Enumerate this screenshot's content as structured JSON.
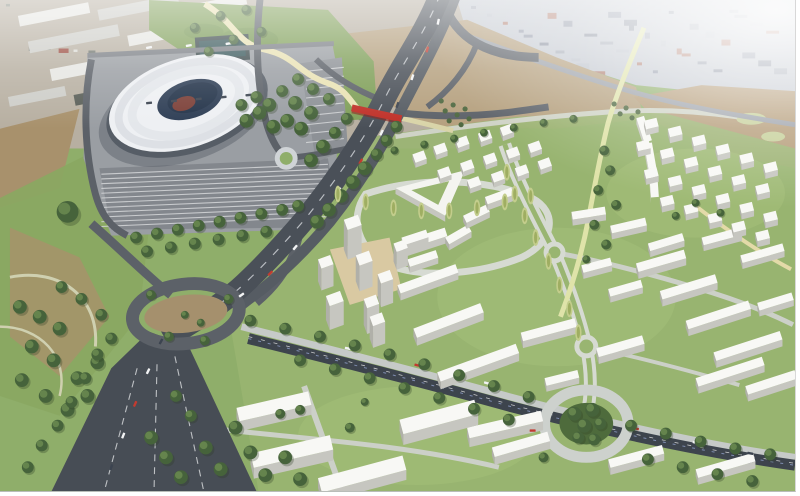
{
  "palette": {
    "grassBase": "#8fae6a",
    "devGrass": "#99b571",
    "grassLight": "#a6c17c",
    "hillGreen": "#7f9f58",
    "parkGreen": "#8aa862",
    "earth": "#b5a07e",
    "earthDark": "#a8916c",
    "fieldBrown": "#b49b77",
    "industrial": "#b7afa1",
    "cityBase": "#c3c8d0",
    "apron": "#9a9ea3",
    "parkingLot": "#83878d",
    "motorway": "#4a5058",
    "motorwayWide": "#474d55",
    "roadMid": "#5c6168",
    "roadLight": "#ccd1cc",
    "railDark": "#3d444d",
    "pathCream": "#e9e2b4",
    "pathOlive": "#dfe3a9",
    "bridgeRed": "#c03028",
    "roofWhite": "#f8f8f5",
    "sideGray": "#c6c6c0",
    "endGray": "#b0b0a9",
    "stadiumRoof": "#eef0f3",
    "stadiumBowl": "#2e3e55",
    "stadiumPlinth": "#565d66",
    "pitchRed": "#7c4038",
    "tree": "#46633b",
    "treeLight": "#6d8c52",
    "poplar": "#c3cd8c",
    "olive": "#4e6840",
    "sand": "#d9c9a2",
    "haze": "#ffffff"
  },
  "buildings": {
    "slabs": [
      [
        398,
        246,
        52,
        -18,
        9,
        7
      ],
      [
        400,
        288,
        62,
        -20,
        9,
        7
      ],
      [
        416,
        332,
        72,
        -21,
        10,
        8
      ],
      [
        440,
        376,
        84,
        -20,
        10,
        8
      ],
      [
        470,
        432,
        76,
        -13,
        11,
        9
      ],
      [
        495,
        452,
        58,
        -16,
        10,
        8
      ],
      [
        448,
        240,
        26,
        -30,
        8,
        6
      ],
      [
        466,
        218,
        26,
        -26,
        8,
        6
      ],
      [
        488,
        199,
        28,
        -20,
        8,
        6
      ],
      [
        575,
        214,
        34,
        -9,
        8,
        6
      ],
      [
        614,
        228,
        36,
        -13,
        8,
        6
      ],
      [
        652,
        246,
        36,
        -17,
        8,
        6
      ],
      [
        585,
        268,
        30,
        -15,
        8,
        6
      ],
      [
        612,
        292,
        34,
        -16,
        8,
        6
      ],
      [
        640,
        266,
        50,
        -16,
        9,
        7
      ],
      [
        664,
        294,
        58,
        -17,
        9,
        7
      ],
      [
        690,
        324,
        66,
        -18,
        9,
        7
      ],
      [
        718,
        356,
        70,
        -18,
        9,
        7
      ],
      [
        750,
        390,
        52,
        -18,
        9,
        7
      ],
      [
        706,
        240,
        40,
        -15,
        8,
        6
      ],
      [
        745,
        258,
        44,
        -16,
        8,
        6
      ],
      [
        762,
        306,
        36,
        -17,
        8,
        6
      ],
      [
        524,
        336,
        56,
        -15,
        9,
        7
      ],
      [
        600,
        352,
        48,
        -16,
        9,
        7
      ],
      [
        700,
        382,
        70,
        -18,
        9,
        7
      ],
      [
        548,
        382,
        34,
        -14,
        8,
        6
      ],
      [
        612,
        464,
        56,
        -15,
        9,
        7
      ],
      [
        700,
        474,
        60,
        -16,
        9,
        7
      ],
      [
        238,
        412,
        74,
        -13,
        14,
        10
      ],
      [
        252,
        458,
        82,
        -13,
        15,
        11
      ],
      [
        402,
        424,
        78,
        -15,
        15,
        11
      ],
      [
        320,
        483,
        88,
        -15,
        15,
        10
      ],
      [
        404,
        240,
        26,
        -18,
        8,
        6
      ],
      [
        410,
        262,
        30,
        -18,
        8,
        6
      ],
      [
        648,
        117,
        26,
        72,
        8,
        6
      ],
      [
        656,
        144,
        26,
        80,
        8,
        6
      ],
      [
        661,
        171,
        28,
        86,
        8,
        6
      ]
    ],
    "towers": [
      [
        346,
        222,
        15,
        -20,
        11,
        30
      ],
      [
        320,
        262,
        13,
        -20,
        10,
        22
      ],
      [
        358,
        258,
        14,
        -20,
        11,
        26
      ],
      [
        380,
        277,
        13,
        -20,
        10,
        24
      ],
      [
        328,
        299,
        15,
        -20,
        11,
        24
      ],
      [
        366,
        302,
        13,
        -20,
        10,
        26
      ],
      [
        396,
        246,
        12,
        -20,
        9,
        18
      ],
      [
        372,
        320,
        13,
        -20,
        10,
        22
      ]
    ],
    "cubes_a": {
      "len": 12,
      "ang": -20,
      "dep": 9,
      "h": 5,
      "points": [
        [
          415,
          156
        ],
        [
          436,
          148
        ],
        [
          458,
          141
        ],
        [
          481,
          135
        ],
        [
          503,
          129
        ],
        [
          440,
          172
        ],
        [
          463,
          165
        ],
        [
          486,
          158
        ],
        [
          509,
          152
        ],
        [
          531,
          146
        ],
        [
          470,
          182
        ],
        [
          494,
          176
        ],
        [
          518,
          170
        ],
        [
          541,
          163
        ]
      ]
    },
    "cubes_b": {
      "len": 13,
      "ang": -14,
      "dep": 9,
      "h": 6,
      "points": [
        [
          648,
          122
        ],
        [
          672,
          130
        ],
        [
          696,
          139
        ],
        [
          720,
          148
        ],
        [
          744,
          157
        ],
        [
          768,
          166
        ],
        [
          640,
          144
        ],
        [
          664,
          152
        ],
        [
          688,
          161
        ],
        [
          712,
          170
        ],
        [
          736,
          179
        ],
        [
          760,
          188
        ],
        [
          648,
          172
        ],
        [
          672,
          180
        ],
        [
          696,
          189
        ],
        [
          720,
          198
        ],
        [
          744,
          207
        ],
        [
          768,
          216
        ],
        [
          664,
          200
        ],
        [
          688,
          208
        ],
        [
          712,
          217
        ],
        [
          736,
          226
        ],
        [
          760,
          235
        ]
      ]
    },
    "warehouses": {
      "rot": -11,
      "colors": [
        "#e6e6e2",
        "#cdcdc8",
        "#595e57"
      ],
      "items": [
        [
          18,
          16,
          72,
          11,
          0
        ],
        [
          98,
          10,
          82,
          11,
          1
        ],
        [
          186,
          6,
          62,
          10,
          0
        ],
        [
          28,
          42,
          92,
          12,
          1
        ],
        [
          128,
          36,
          76,
          11,
          0
        ],
        [
          212,
          28,
          56,
          10,
          2
        ],
        [
          50,
          70,
          86,
          12,
          0
        ],
        [
          146,
          62,
          72,
          11,
          1
        ],
        [
          8,
          98,
          58,
          10,
          1
        ],
        [
          74,
          96,
          66,
          11,
          2
        ],
        [
          250,
          48,
          46,
          9,
          0
        ],
        [
          260,
          18,
          50,
          9,
          1
        ]
      ]
    }
  },
  "vegetation": {
    "trees": [
      [
        399,
        128,
        6
      ],
      [
        389,
        142,
        6
      ],
      [
        379,
        156,
        6
      ],
      [
        367,
        170,
        7
      ],
      [
        355,
        184,
        7
      ],
      [
        343,
        198,
        7
      ],
      [
        331,
        212,
        7
      ],
      [
        319,
        224,
        7
      ],
      [
        349,
        120,
        6
      ],
      [
        337,
        134,
        6
      ],
      [
        325,
        148,
        7
      ],
      [
        313,
        162,
        7
      ],
      [
        300,
        80,
        6
      ],
      [
        315,
        90,
        6
      ],
      [
        331,
        100,
        6
      ],
      [
        297,
        104,
        7
      ],
      [
        313,
        114,
        7
      ],
      [
        284,
        92,
        6
      ],
      [
        271,
        106,
        7
      ],
      [
        289,
        122,
        7
      ],
      [
        303,
        130,
        7
      ],
      [
        275,
        128,
        7
      ],
      [
        261,
        114,
        7
      ],
      [
        248,
        122,
        7
      ],
      [
        258,
        98,
        6
      ],
      [
        243,
        106,
        6
      ],
      [
        196,
        28,
        5
      ],
      [
        222,
        16,
        5
      ],
      [
        248,
        10,
        5
      ],
      [
        263,
        32,
        5
      ],
      [
        235,
        40,
        5
      ],
      [
        210,
        52,
        5
      ],
      [
        137,
        240,
        6
      ],
      [
        158,
        236,
        6
      ],
      [
        179,
        232,
        6
      ],
      [
        200,
        228,
        6
      ],
      [
        221,
        224,
        6
      ],
      [
        242,
        220,
        6
      ],
      [
        263,
        216,
        6
      ],
      [
        284,
        212,
        6
      ],
      [
        300,
        208,
        6
      ],
      [
        148,
        254,
        6
      ],
      [
        172,
        250,
        6
      ],
      [
        196,
        246,
        6
      ],
      [
        220,
        242,
        6
      ],
      [
        244,
        238,
        6
      ],
      [
        268,
        234,
        6
      ],
      [
        20,
        310,
        7
      ],
      [
        40,
        320,
        7
      ],
      [
        60,
        332,
        7
      ],
      [
        32,
        350,
        7
      ],
      [
        54,
        364,
        7
      ],
      [
        22,
        384,
        7
      ],
      [
        46,
        400,
        7
      ],
      [
        68,
        414,
        7
      ],
      [
        88,
        400,
        7
      ],
      [
        62,
        290,
        6
      ],
      [
        82,
        302,
        6
      ],
      [
        102,
        318,
        6
      ],
      [
        112,
        342,
        6
      ],
      [
        98,
        366,
        7
      ],
      [
        78,
        382,
        7
      ],
      [
        68,
        214,
        11
      ],
      [
        152,
        298,
        5
      ],
      [
        170,
        340,
        5
      ],
      [
        206,
        344,
        5
      ],
      [
        230,
        302,
        5
      ],
      [
        186,
        318,
        4
      ],
      [
        202,
        326,
        4
      ],
      [
        152,
        442,
        7
      ],
      [
        167,
        462,
        7
      ],
      [
        182,
        482,
        7
      ],
      [
        207,
        452,
        7
      ],
      [
        222,
        474,
        7
      ],
      [
        252,
        457,
        7
      ],
      [
        267,
        480,
        7
      ],
      [
        287,
        462,
        7
      ],
      [
        302,
        484,
        7
      ],
      [
        237,
        432,
        7
      ],
      [
        192,
        420,
        6
      ],
      [
        177,
        400,
        6
      ],
      [
        98,
        358,
        6
      ],
      [
        86,
        382,
        6
      ],
      [
        72,
        406,
        6
      ],
      [
        58,
        430,
        6
      ],
      [
        42,
        450,
        6
      ],
      [
        28,
        472,
        6
      ],
      [
        252,
        324,
        6
      ],
      [
        287,
        332,
        6
      ],
      [
        322,
        340,
        6
      ],
      [
        357,
        349,
        6
      ],
      [
        392,
        358,
        6
      ],
      [
        427,
        368,
        6
      ],
      [
        462,
        379,
        6
      ],
      [
        497,
        390,
        6
      ],
      [
        532,
        401,
        6
      ],
      [
        635,
        430,
        6
      ],
      [
        670,
        438,
        6
      ],
      [
        705,
        446,
        6
      ],
      [
        740,
        453,
        6
      ],
      [
        775,
        459,
        6
      ],
      [
        302,
        364,
        6
      ],
      [
        337,
        373,
        6
      ],
      [
        372,
        382,
        6
      ],
      [
        407,
        392,
        6
      ],
      [
        442,
        402,
        6
      ],
      [
        477,
        413,
        6
      ],
      [
        512,
        424,
        6
      ],
      [
        652,
        464,
        6
      ],
      [
        687,
        472,
        6
      ],
      [
        722,
        479,
        6
      ],
      [
        757,
        486,
        6
      ],
      [
        578,
        418,
        7
      ],
      [
        596,
        414,
        7
      ],
      [
        588,
        430,
        7
      ],
      [
        604,
        428,
        6
      ],
      [
        582,
        442,
        6
      ],
      [
        598,
        444,
        6
      ],
      [
        397,
        152,
        4
      ],
      [
        427,
        146,
        4
      ],
      [
        457,
        140,
        4
      ],
      [
        487,
        134,
        4
      ],
      [
        517,
        129,
        4
      ],
      [
        547,
        124,
        4
      ],
      [
        577,
        120,
        4
      ],
      [
        608,
        152,
        5
      ],
      [
        614,
        172,
        5
      ],
      [
        602,
        192,
        5
      ],
      [
        620,
        207,
        5
      ],
      [
        598,
        227,
        5
      ],
      [
        610,
        247,
        5
      ],
      [
        590,
        262,
        4
      ],
      [
        282,
        418,
        5
      ],
      [
        302,
        414,
        5
      ],
      [
        352,
        432,
        5
      ],
      [
        547,
        462,
        5
      ],
      [
        367,
        406,
        4
      ],
      [
        700,
        205,
        4
      ],
      [
        725,
        215,
        4
      ],
      [
        680,
        218,
        4
      ]
    ],
    "poplars": [
      [
        340,
        196
      ],
      [
        368,
        204
      ],
      [
        396,
        210
      ],
      [
        424,
        213
      ],
      [
        452,
        213
      ],
      [
        480,
        210
      ],
      [
        508,
        204
      ],
      [
        534,
        198
      ],
      [
        510,
        174
      ],
      [
        518,
        196
      ],
      [
        528,
        218
      ],
      [
        539,
        240
      ],
      [
        552,
        264
      ],
      [
        563,
        288
      ],
      [
        573,
        312
      ],
      [
        582,
        336
      ]
    ],
    "olives": [
      [
        444,
        102
      ],
      [
        456,
        106
      ],
      [
        468,
        110
      ],
      [
        448,
        112
      ],
      [
        460,
        116
      ],
      [
        472,
        120
      ],
      [
        452,
        122
      ],
      [
        464,
        126
      ],
      [
        618,
        105
      ],
      [
        630,
        109
      ],
      [
        642,
        113
      ],
      [
        624,
        115
      ],
      [
        636,
        119
      ]
    ]
  },
  "traffic": {
    "car_colors": [
      "#f2f3f4",
      "#c23b30",
      "#3c4450"
    ],
    "cars": [
      [
        441,
        22,
        -78,
        0
      ],
      [
        430,
        50,
        -75,
        1
      ],
      [
        415,
        78,
        -72,
        0
      ],
      [
        400,
        106,
        -70,
        2
      ],
      [
        384,
        134,
        -65,
        0
      ],
      [
        363,
        163,
        -60,
        1
      ],
      [
        341,
        192,
        -55,
        0
      ],
      [
        319,
        221,
        -52,
        2
      ],
      [
        297,
        250,
        -50,
        0
      ],
      [
        272,
        276,
        -45,
        1
      ],
      [
        243,
        298,
        -35,
        0
      ],
      [
        162,
        345,
        -62,
        2
      ],
      [
        149,
        375,
        -64,
        0
      ],
      [
        136,
        408,
        -66,
        1
      ],
      [
        124,
        440,
        -68,
        0
      ],
      [
        112,
        472,
        -70,
        2
      ],
      [
        350,
        352,
        12,
        0
      ],
      [
        420,
        369,
        14,
        1
      ],
      [
        490,
        387,
        15,
        0
      ],
      [
        640,
        433,
        12,
        1
      ],
      [
        700,
        447,
        11,
        0
      ],
      [
        755,
        458,
        10,
        2
      ],
      [
        150,
        48,
        -10,
        0
      ],
      [
        190,
        46,
        -10,
        0
      ],
      [
        230,
        44,
        -10,
        0
      ],
      [
        150,
        104,
        -6,
        2
      ],
      [
        175,
        102,
        -6,
        2
      ],
      [
        200,
        100,
        -6,
        2
      ],
      [
        225,
        98,
        -6,
        2
      ],
      [
        250,
        96,
        -6,
        2
      ],
      [
        536,
        435,
        0,
        1
      ]
    ]
  },
  "parking": {
    "main": {
      "x1": 102,
      "y1": 176,
      "x2": 330,
      "y2": 166,
      "count": 12,
      "step": 4.8
    },
    "east": {
      "x1": 308,
      "y1": 72,
      "x2": 346,
      "y2": 68,
      "count": 9,
      "step": 9
    }
  }
}
